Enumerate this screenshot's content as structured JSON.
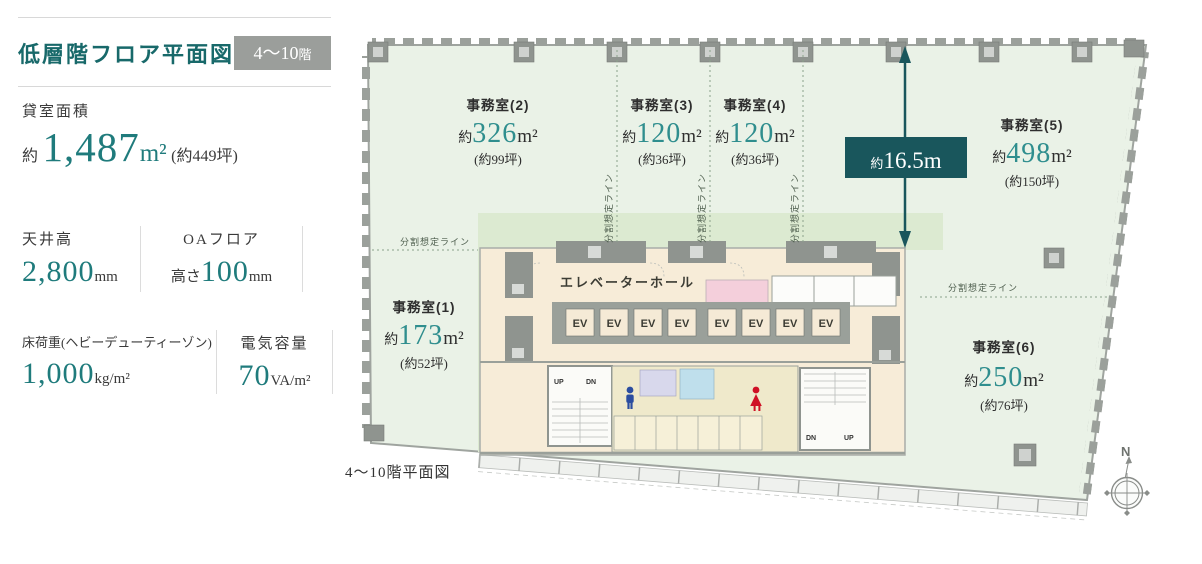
{
  "header": {
    "title": "低層階フロア平面図",
    "floor_badge": {
      "range": "4〜10",
      "suffix": "階"
    }
  },
  "specs": {
    "rental_area": {
      "label": "貸室面積",
      "approx": "約",
      "value": "1,487",
      "unit": "m²",
      "tsubo": "(約449坪)"
    },
    "ceiling_height": {
      "label": "天井高",
      "value": "2,800",
      "unit": "mm"
    },
    "oa_floor": {
      "label": "OAフロア",
      "prefix": "高さ",
      "value": "100",
      "unit": "mm"
    },
    "floor_load": {
      "label": "床荷重(ヘビーデューティーゾン)",
      "value": "1,000",
      "unit": "kg/m²"
    },
    "electric_capacity": {
      "label": "電気容量",
      "value": "70",
      "unit": "VA/m²"
    }
  },
  "plan": {
    "caption": "4〜10階平面図",
    "hall_label": "エレベーターホール",
    "ev_label": "EV",
    "up_label": "UP",
    "dn_label": "DN",
    "division_line_label": "分割想定ライン",
    "dimension": {
      "approx": "約",
      "value": "16.5m"
    },
    "north_label": "N",
    "rooms": [
      {
        "name": "事務室(1)",
        "approx": "約",
        "value": "173",
        "unit": "m²",
        "tsubo": "(約52坪)"
      },
      {
        "name": "事務室(2)",
        "approx": "約",
        "value": "326",
        "unit": "m²",
        "tsubo": "(約99坪)"
      },
      {
        "name": "事務室(3)",
        "approx": "約",
        "value": "120",
        "unit": "m²",
        "tsubo": "(約36坪)"
      },
      {
        "name": "事務室(4)",
        "approx": "約",
        "value": "120",
        "unit": "m²",
        "tsubo": "(約36坪)"
      },
      {
        "name": "事務室(5)",
        "approx": "約",
        "value": "498",
        "unit": "m²",
        "tsubo": "(約150坪)"
      },
      {
        "name": "事務室(6)",
        "approx": "約",
        "value": "250",
        "unit": "m²",
        "tsubo": "(約76坪)"
      }
    ]
  },
  "colors": {
    "accent_teal": "#18696a",
    "value_teal": "#2f8e8e",
    "dimension_box_teal": "#19565c",
    "badge_gray": "#9b9e9b",
    "office_green": "#eaf2e7",
    "inner_zone_green": "#dcead1",
    "core_cream": "#f7ecd8"
  }
}
